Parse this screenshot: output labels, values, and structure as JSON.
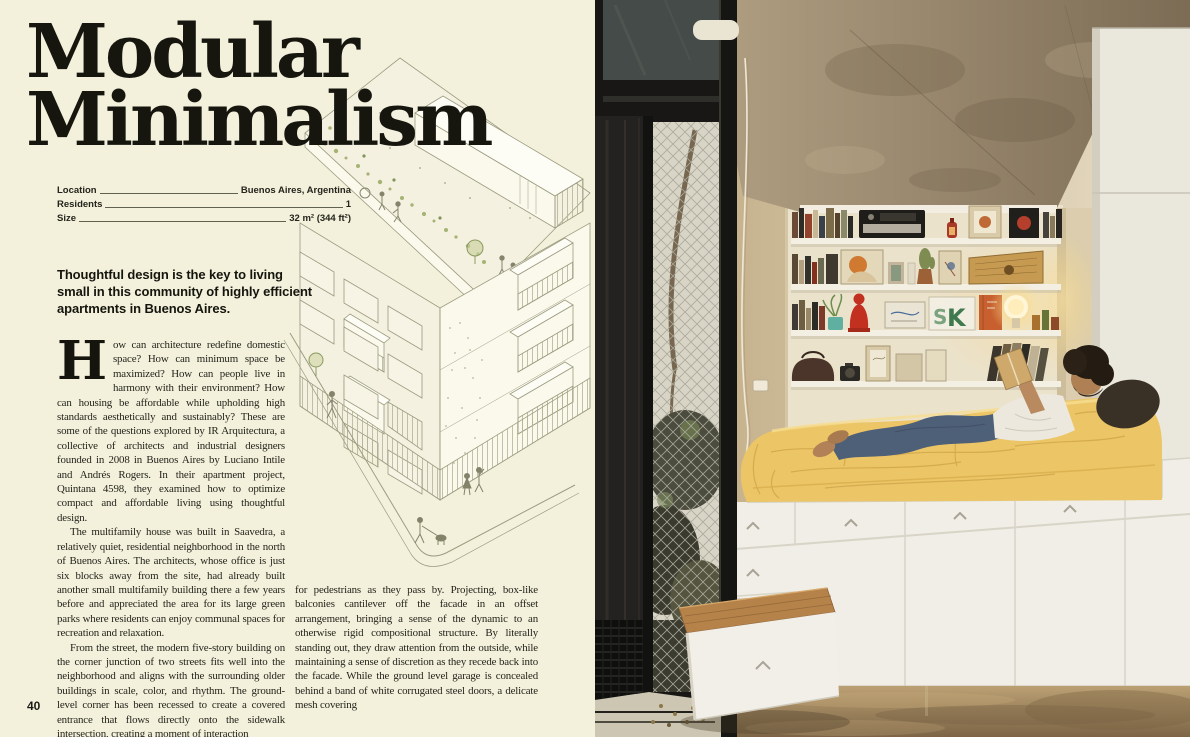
{
  "article": {
    "title_line1": "Modular",
    "title_line2": "Minimalism",
    "meta": [
      {
        "label": "Location",
        "value": "Buenos Aires, Argentina"
      },
      {
        "label": "Residents",
        "value": "1"
      },
      {
        "label": "Size",
        "value": "32 m² (344 ft²)"
      }
    ],
    "standfirst": "Thoughtful design is the key to living small in this community of highly efficient apartments in Buenos Aires.",
    "dropcap": "H",
    "col1_p1": "ow can architecture redefine domestic space? How can minimum space be maximized? How can people live in harmony with their environment? How can housing be affordable while upholding high standards aesthetically and sustainably? These are some of the questions explored by IR Arquitectura, a collective of architects and industrial designers founded in 2008 in Buenos Aires by Luciano Intile and Andrés Rogers. In their apartment project, Quintana 4598, they examined how to optimize compact and affordable living using thoughtful design.",
    "col1_p2": "The multifamily house was built in Saavedra, a relatively quiet, residential neighborhood in the north of Buenos Aires. The architects, whose office is just six blocks away from the site, had already built another small multifamily building there a few years before and appreciated the area for its large green parks where residents can enjoy communal spaces for recreation and relaxation.",
    "col1_p3": "From the street, the modern five-story building on the corner junction of two streets fits well into the neighborhood and aligns with the surrounding older buildings in scale, color, and rhythm. The ground-level corner has been recessed to create a covered entrance that flows directly onto the sidewalk intersection, creating a moment of interaction",
    "col2_p1": "for pedestrians as they pass by. Projecting, box-like balconies cantilever off the facade in an offset arrangement, bringing a sense of the dynamic to an otherwise rigid compositional structure. By literally standing out, they draw attention from the outside, while maintaining a sense of discretion as they recede back into the facade. While the ground level garage is concealed behind a band of white corrugated steel doors, a delicate mesh covering",
    "page_number": "40"
  },
  "illustration": {
    "description": "Axonometric line drawing of the five-story corner building with rooftop terrace, greenery, cantilevered balconies and pedestrians on the sidewalk"
  },
  "photo": {
    "description": "Resident reading a book on a raised platform bed with yellow bedding; white bookshelves above, storage drawers and a pulled-out wooden bench below, black steel window wall at left, raw concrete ceiling",
    "artwork_letters": {
      "s": "S",
      "k": "K"
    }
  },
  "palette": {
    "page_background": "#f3f1dc",
    "ink": "#16160f",
    "drawing_line_olive": "#9c9c80",
    "bedspread_yellow": "#ecc566",
    "concrete_ceiling": "#8d7c64",
    "wall_beige": "#d9c9a9",
    "cabinet_white": "#f0eee6",
    "window_frame_black": "#181715",
    "floor_brown": "#a08457",
    "wood_bench": "#b5824a",
    "lamp_glow": "#ffe6a8",
    "buddha_red": "#c23120"
  }
}
